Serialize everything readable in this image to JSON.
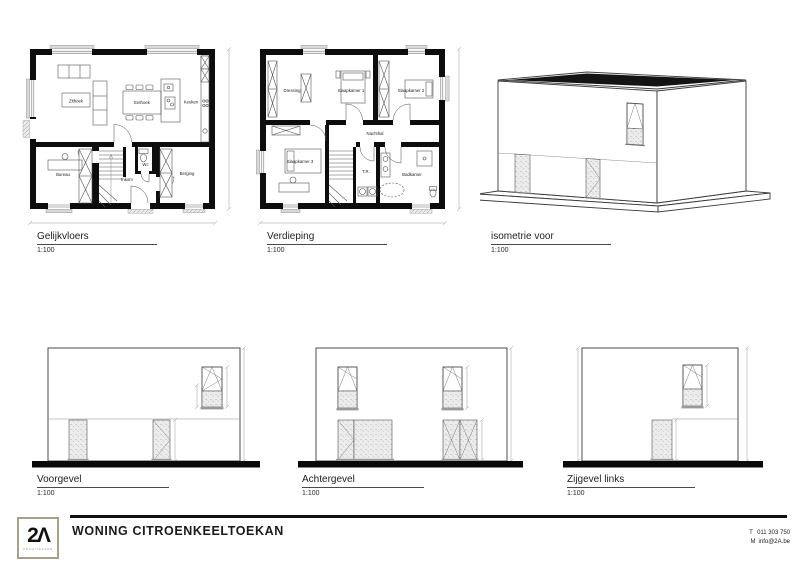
{
  "titleblock": {
    "project_title": "WONING CITROENKEELTOEKAN",
    "logo_mark": "2Λ",
    "logo_subtitle": "ARCHITECTEN",
    "phone_label": "T",
    "phone": "011 303 750",
    "email_label": "M",
    "email": "info@2A.be",
    "accent_color": "#a8a08a"
  },
  "figures": {
    "gelijkvloers": {
      "title": "Gelijkvloers",
      "scale": "1:100",
      "rooms": {
        "zithoek": "Zithoek",
        "eethoek": "Eethoek",
        "keuken": "Keuken",
        "bureau": "Bureau",
        "inkom": "Inkom",
        "wc": "Wc",
        "berging": "Berging"
      }
    },
    "verdieping": {
      "title": "Verdieping",
      "scale": "1:100",
      "rooms": {
        "dressing": "Dressing",
        "slaapkamer1": "Slaapkamer 1",
        "slaapkamer2": "Slaapkamer 2",
        "slaapkamer3": "Slaapkamer 3",
        "nachthal": "Nachthal",
        "tr": "T.R.",
        "badkamer": "Badkamer"
      }
    },
    "isometrie": {
      "title": "isometrie voor",
      "scale": "1:100"
    },
    "voorgevel": {
      "title": "Voorgevel",
      "scale": "1:100"
    },
    "achtergevel": {
      "title": "Achtergevel",
      "scale": "1:100"
    },
    "zijgevel_links": {
      "title": "Zijgevel links",
      "scale": "1:100"
    }
  }
}
